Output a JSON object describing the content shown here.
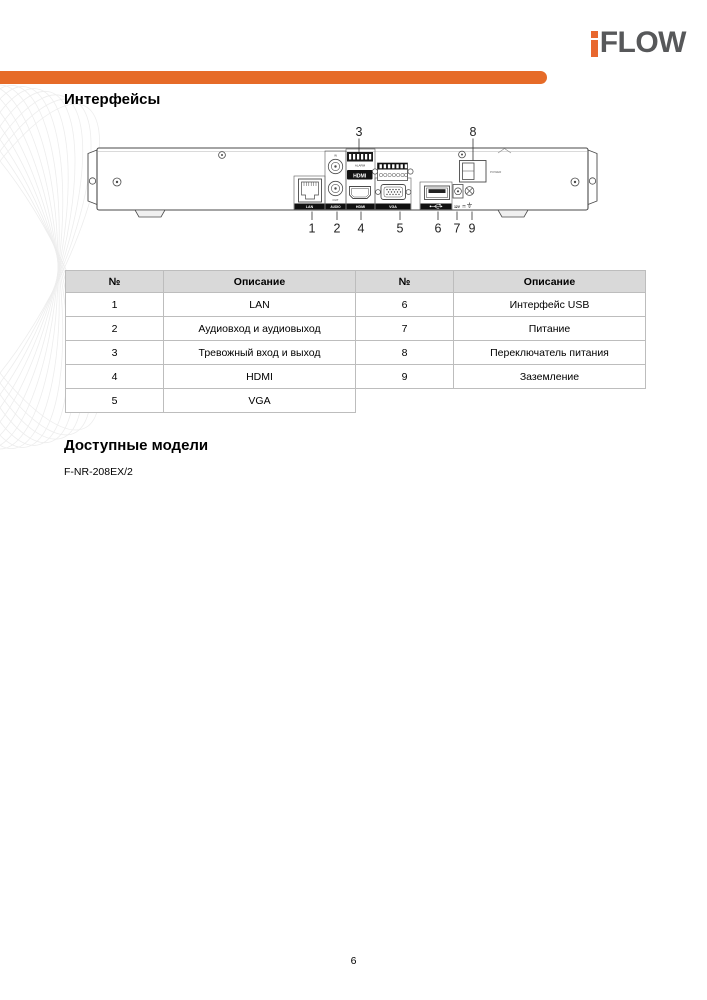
{
  "page": {
    "number": "6"
  },
  "logo": {
    "text": "FLOW",
    "accent": "i-mark",
    "accent_color": "#E8672E",
    "text_color": "#57585A"
  },
  "headings": {
    "interfaces": "Интерфейсы",
    "models": "Доступные модели"
  },
  "models": {
    "items": [
      "F-NR-208EX/2"
    ]
  },
  "diagram": {
    "port_labels": {
      "lan": "LAN",
      "audio": "AUDIO",
      "audio_in": "IN",
      "audio_out": "OUT",
      "alarm": "ALARM",
      "hdmi_logo": "HDMI",
      "hdmi": "HDMI",
      "vga": "VGA",
      "power_switch": "POWER",
      "power": "12V"
    },
    "callouts": {
      "top": [
        "3",
        "8"
      ],
      "bottom": [
        "1",
        "2",
        "4",
        "5",
        "6",
        "7",
        "9"
      ]
    }
  },
  "table": {
    "left": {
      "headers": [
        "№",
        "Описание"
      ],
      "rows": [
        [
          "1",
          "LAN"
        ],
        [
          "2",
          "Аудиовход и аудиовыход"
        ],
        [
          "3",
          "Тревожный вход и выход"
        ],
        [
          "4",
          "HDMI"
        ],
        [
          "5",
          "VGA"
        ]
      ]
    },
    "right": {
      "headers": [
        "№",
        "Описание"
      ],
      "rows": [
        [
          "6",
          "Интерфейс USB"
        ],
        [
          "7",
          "Питание"
        ],
        [
          "8",
          "Переключатель питания"
        ],
        [
          "9",
          "Заземление"
        ]
      ]
    }
  },
  "colors": {
    "accent_orange": "#E66B28",
    "logo_gray": "#57585A",
    "table_header_bg": "#D9D9D9",
    "table_border": "#BDBDBD"
  }
}
